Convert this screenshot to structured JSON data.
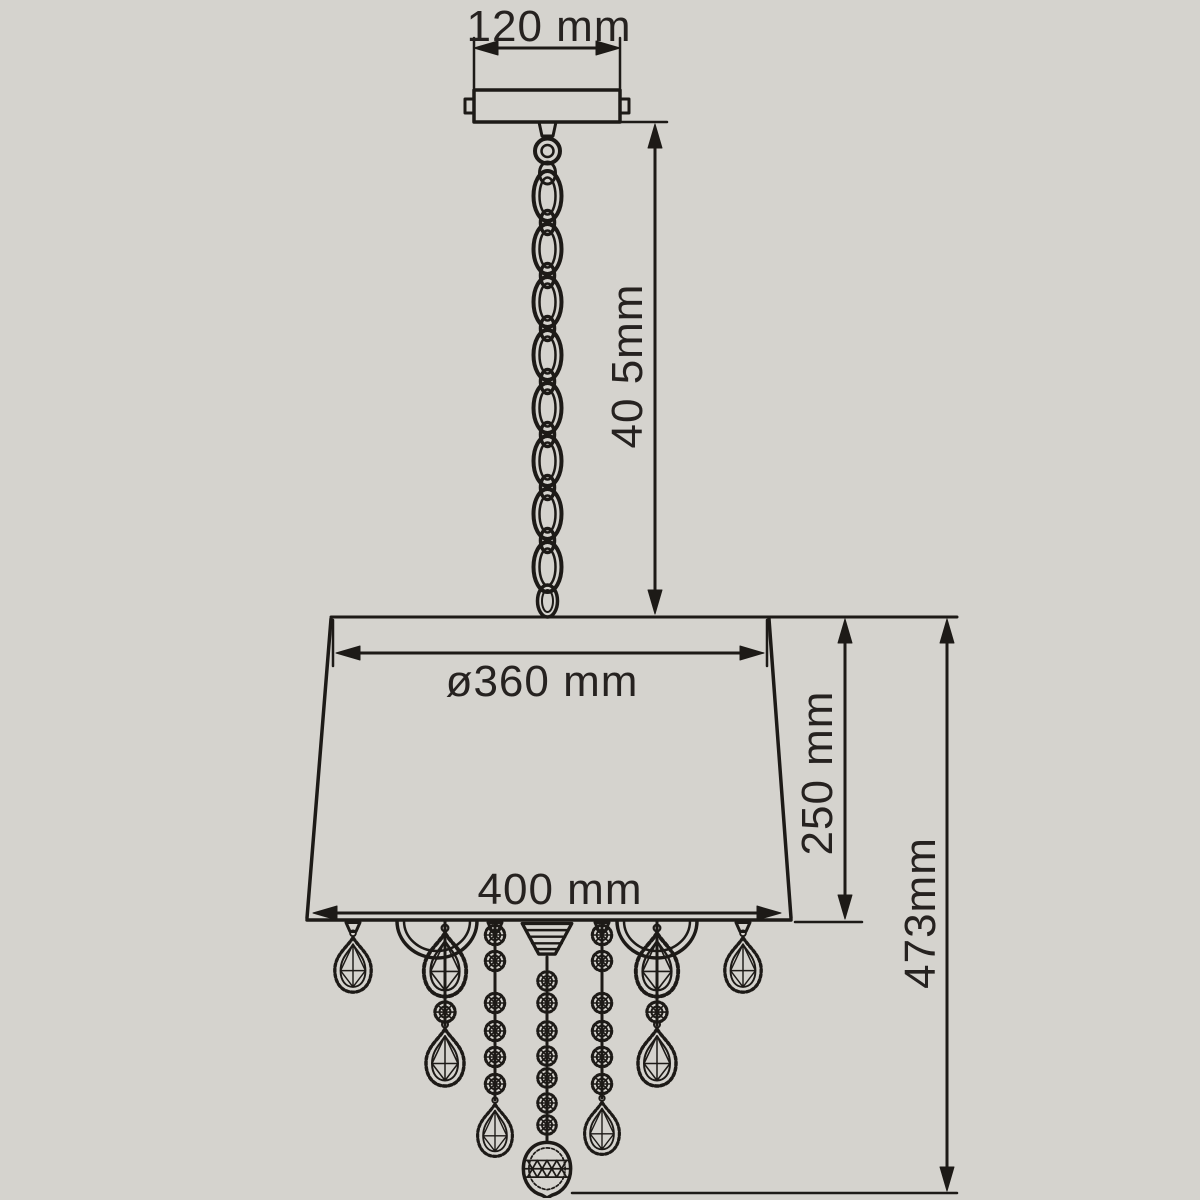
{
  "diagram": {
    "labels": {
      "canopy_width": "120 mm",
      "chain_length": "40 5mm",
      "shade_top_diameter": "ø360 mm",
      "shade_height": "250 mm",
      "shade_bottom_diameter": "400 mm",
      "overall_height": "473mm"
    },
    "colors": {
      "background": "#d5d3ce",
      "line": "#1d1a17",
      "text": "#262220"
    }
  }
}
